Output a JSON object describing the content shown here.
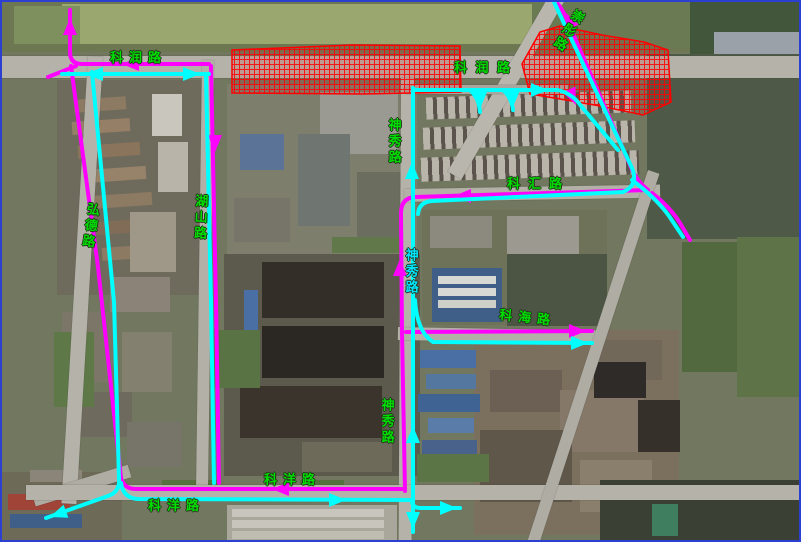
{
  "map": {
    "frame_color": "#2b3fd0",
    "label_color": "#00dd00",
    "closure": {
      "color": "#ff0000",
      "zones": [
        "230,48 350,43 458,44 459,90 360,92 230,91",
        "520,62 538,30 558,24 600,33 642,40 666,48 669,100 641,113 598,104 558,97 528,92"
      ]
    },
    "labels": [
      {
        "text": "科润路",
        "x": 108,
        "y": 50,
        "mode": "h",
        "ls": 6
      },
      {
        "text": "科 润 路",
        "x": 452,
        "y": 60,
        "mode": "h",
        "ls": 2
      },
      {
        "text": "崇彤路",
        "x": 558,
        "y": 4,
        "mode": "v",
        "rot": 32
      },
      {
        "text": "弘德路",
        "x": 80,
        "y": 200,
        "mode": "v",
        "rot": 8
      },
      {
        "text": "湖山路",
        "x": 190,
        "y": 192,
        "mode": "v",
        "rot": 2
      },
      {
        "text": "神秀路",
        "x": 384,
        "y": 116,
        "mode": "v",
        "rot": 0
      },
      {
        "text": "神秀路",
        "x": 401,
        "y": 246,
        "mode": "v",
        "rot": 0,
        "color": "#00e5ff"
      },
      {
        "text": "神秀路",
        "x": 377,
        "y": 396,
        "mode": "v",
        "rot": 0
      },
      {
        "text": "科汇路",
        "x": 505,
        "y": 176,
        "mode": "h",
        "ls": 8
      },
      {
        "text": "科海路",
        "x": 497,
        "y": 310,
        "mode": "h",
        "ls": 6,
        "rot": 6
      },
      {
        "text": "科洋路",
        "x": 262,
        "y": 472,
        "mode": "h",
        "ls": 6
      },
      {
        "text": "科洋路",
        "x": 146,
        "y": 498,
        "mode": "h",
        "ls": 6
      }
    ],
    "routes": {
      "magenta": {
        "color": "#ff00ff",
        "width": 4,
        "paths": [
          "M 68 8 L 68 50 Q 68 62 80 62 L 207 62",
          "M 74 64 L 46 75",
          "M 69 64 L 96 265 L 119 476 Q 122 487 134 487 L 400 487",
          "M 209 64 L 214 300 L 217 481",
          "M 403 489 L 400 330 L 399 211 Q 399 196 413 195 L 646 188",
          "M 646 188 Q 637 181 631 170 L 566 20 Q 561 8 556 2",
          "M 650 191 Q 668 205 678 221 L 688 238",
          "M 404 330 L 590 329"
        ],
        "arrows": [
          [
            68,
            16,
            -90
          ],
          [
            120,
            62,
            180
          ],
          [
            270,
            487,
            180
          ],
          [
            398,
            257,
            -90
          ],
          [
            452,
            194,
            180
          ],
          [
            584,
            329,
            0
          ],
          [
            563,
            10,
            -114
          ],
          [
            574,
            103,
            66
          ],
          [
            213,
            150,
            90
          ]
        ]
      },
      "cyan": {
        "color": "#00ffff",
        "width": 4,
        "paths": [
          "M 60 72 L 207 72",
          "M 90 70 L 112 300 L 117 477",
          "M 117 477 Q 118 490 106 494 L 44 516",
          "M 119 481 Q 121 496 136 497 L 410 498",
          "M 204 74 L 209 300 L 212 481",
          "M 411 86 L 411 530",
          "M 411 88 L 556 88 Q 571 92 579 104 L 616 148",
          "M 468 88 Q 477 96 478 110",
          "M 501 88 Q 510 96 511 108",
          "M 552 0 L 630 166 Q 637 183 621 190 L 430 199 Q 417 200 416 212",
          "M 630 178 Q 655 197 667 214 L 681 235",
          "M 413 298 Q 415 330 431 340 L 590 341",
          "M 410 499 Q 410 506 419 506 L 458 506"
        ],
        "arrows": [
          [
            84,
            72,
            180
          ],
          [
            198,
            72,
            0
          ],
          [
            48,
            515,
            160
          ],
          [
            344,
            498,
            0
          ],
          [
            410,
            160,
            -90
          ],
          [
            411,
            424,
            -90
          ],
          [
            411,
            527,
            90
          ],
          [
            546,
            88,
            0
          ],
          [
            478,
            107,
            90
          ],
          [
            511,
            105,
            90
          ],
          [
            586,
            341,
            0
          ],
          [
            455,
            506,
            0
          ]
        ]
      }
    }
  }
}
